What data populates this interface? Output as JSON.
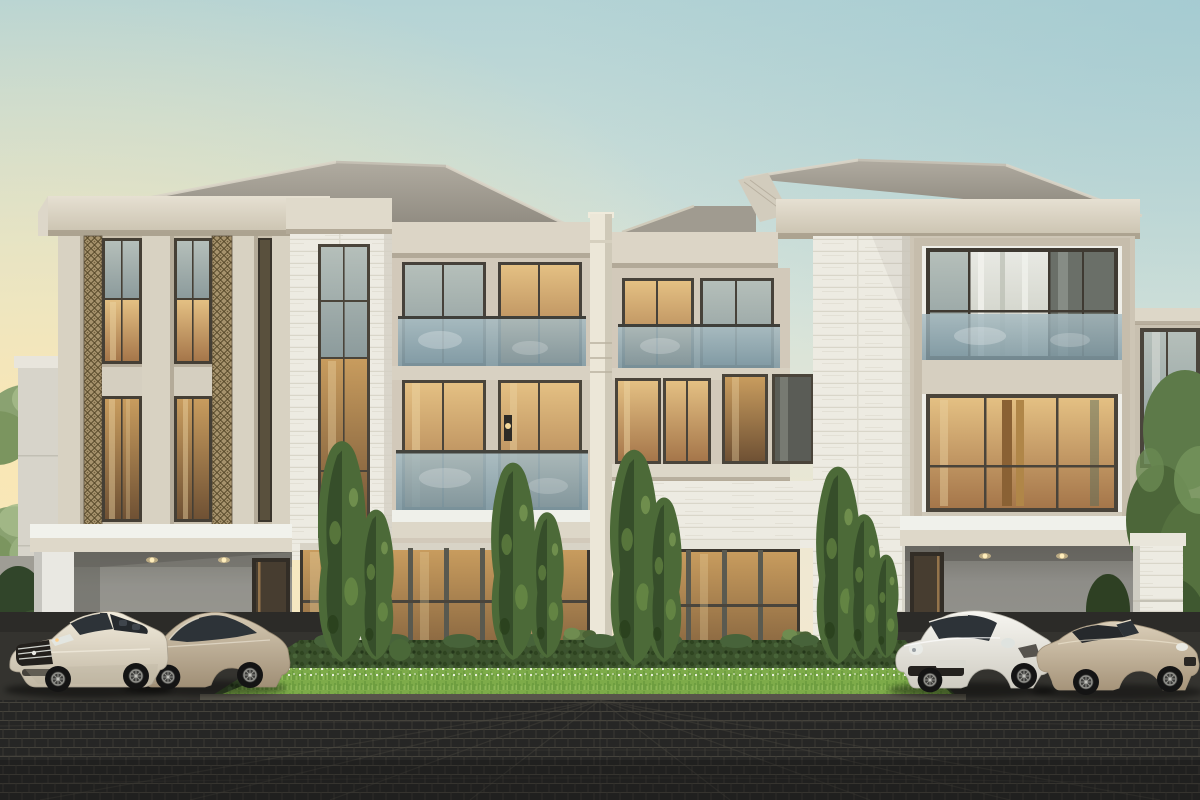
{
  "meta": {
    "description": "3D architectural rendering of two luxury modern-classic three-storey villas at dusk, with lit interiors, cypress landscaping, manicured hedge and grass strip, four luxury cars parked on dark brick paver driveways",
    "image_type": "architectural exterior rendering",
    "time_of_day": "dusk"
  },
  "palette": {
    "sky_top": "#b4d3d5",
    "sky_mid": "#d6e3da",
    "sky_low": "#eee8d3",
    "sky_horizon": "#f5e9ce",
    "sunset_glow": "#fce7b0",
    "cool_corner": "#9cc6cf",
    "roof_light": "#b0aba0",
    "roof_dark": "#8a857b",
    "cornice_light": "#e6e0d2",
    "cornice_dark": "#c9c1ae",
    "facade": "#cdc5b5",
    "facade_recess": "#c9c0ae",
    "facade_wing": "#d2c9ba",
    "column": "#d8d2c2",
    "stone_white": "#edebe2",
    "fretwork": "#a6926c",
    "fretwork_line": "#554728",
    "window_frame": "#453f35",
    "glass_warm_top": "#e4c083",
    "glass_warm_bottom": "#a5764a",
    "glass_deep_top": "#c89c5e",
    "glass_deep_bottom": "#6f5134",
    "glass_cool_top": "#b5bfba",
    "glass_cool_bottom": "#8c9b9c",
    "balcony_glass_top": "#a8bcc2",
    "balcony_glass_bottom": "#7e99a4",
    "curtain": "#e8e9e3",
    "carport_wall": "#8e8d88",
    "pillar": "#ece7d8",
    "door_wood": "#473d30",
    "lamp_glow": "#ffe2a0",
    "hedge": "#3b522c",
    "grass": "#7dab49",
    "cypress": "#4c6a38",
    "cypress_dark": "#2f4526",
    "tree_bg": "#8aa271",
    "tree_right": "#5d7a49",
    "paver": "#262625",
    "paver_joint": "#45433c",
    "curb_top": "#57544a",
    "curb_face": "#2e2c27",
    "apron": "#34332f",
    "car1_body": "#f2ecdd",
    "car2_body": "#d6cab4",
    "car3_body": "#f7f6f1",
    "car4_body": "#dbcfb9",
    "car_glass": "#2d3338",
    "fence": "#d7d4ca"
  },
  "scene": {
    "buildings": [
      {
        "id": "left-villa",
        "style": "modern classic",
        "storeys": 3,
        "features": [
          "hip roof with deep cornice",
          "giant-order columns with bronze fretwork panels",
          "floor-to-ceiling lit windows",
          "glass juliet balconies",
          "white stone pilaster",
          "double carport"
        ]
      },
      {
        "id": "right-villa",
        "style": "modern classic",
        "storeys": 3,
        "features": [
          "hip roof with deep cornice",
          "stacked picture-window box",
          "glass juliet balcony",
          "white stone pilaster",
          "ground-floor french doors",
          "double carport"
        ]
      }
    ],
    "boundary_pillar": {
      "id": "party-wall-pillar",
      "material": "cream stone"
    },
    "cars": [
      {
        "id": "car-1",
        "look": "pearl convertible grand tourer",
        "color_ref": "car1_body",
        "position": "left driveway, front"
      },
      {
        "id": "car-2",
        "look": "champagne sports coupe",
        "color_ref": "car2_body",
        "position": "left driveway, rear"
      },
      {
        "id": "car-3",
        "look": "white mid-engine coupe",
        "color_ref": "car3_body",
        "position": "right driveway, front"
      },
      {
        "id": "car-4",
        "look": "champagne open-top roadster",
        "color_ref": "car4_body",
        "position": "right driveway, rear"
      }
    ],
    "vegetation": {
      "cypress_clusters": 4,
      "hedge_strip": "dark clipped hedge with bright grass and white flower edging",
      "background_trees": "soft green canopies behind walls and between villas",
      "right_tree": "large leafy tree at right edge"
    },
    "hardscape": {
      "paving": "dark charcoal brick pavers",
      "curb": "stone curb in front of garden strip",
      "planters": "classical urns with trailing plants"
    }
  }
}
